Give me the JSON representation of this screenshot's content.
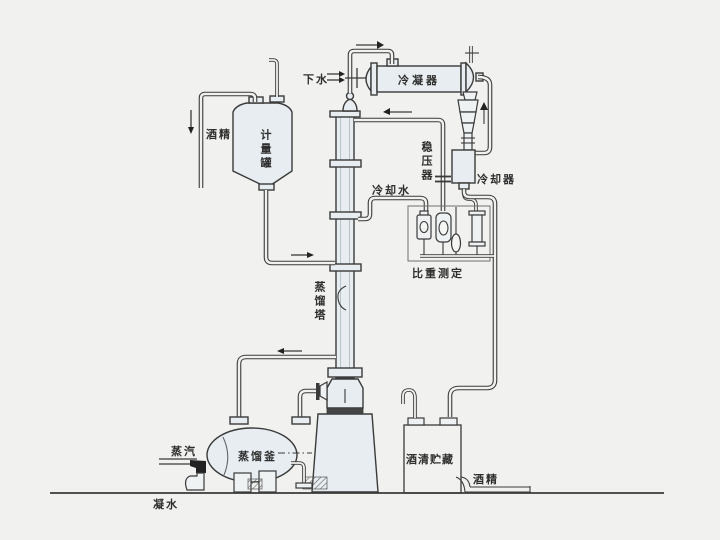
{
  "labels": {
    "drain_water": "下水",
    "condenser": "冷凝器",
    "pressure_stabilizer": "稳压器",
    "cooler": "冷却器",
    "cooling_water": "冷却水",
    "density_measurement": "比重测定",
    "metering_tank": "计量罐",
    "alcohol_feed": "酒精",
    "distillation_column": "蒸馏塔",
    "steam": "蒸汽",
    "distillation_kettle": "蒸馏釜",
    "condensate_water": "凝水",
    "alcohol_storage": "酒清贮藏",
    "alcohol_out": "酒精"
  },
  "colors": {
    "background": "#f1f2ef",
    "line": "#3a3a3a",
    "vessel_fill": "#e7edf0",
    "text": "#2e2e2e"
  }
}
